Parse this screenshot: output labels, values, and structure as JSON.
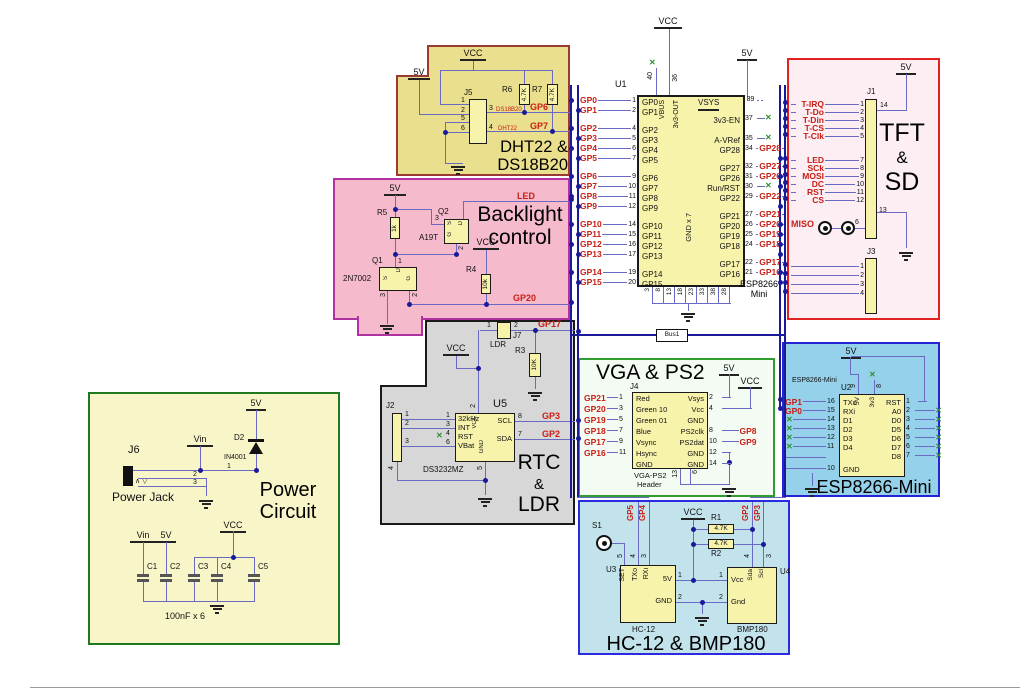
{
  "colors": {
    "bus_wire": "#1a1a99",
    "signal_wire": "#6a6ac4",
    "net_label": "#c81e14",
    "nc_mark": "#2f8f2f",
    "component_fill": "#f8f3ab",
    "dht_fill": "#eadf8d",
    "dht_border": "#9a3a33",
    "backlight_fill": "#f6bacd",
    "backlight_border": "#b231a2",
    "tft_fill": "#fdeef4",
    "tft_border": "#e02222",
    "rtc_fill": "#d7d7d7",
    "rtc_border": "#1a1a1a",
    "vga_fill": "#f3fbf3",
    "vga_border": "#2f9e2f",
    "esp_fill": "#95d1ea",
    "esp_border": "#2424d4",
    "hc12_fill": "#c2e2ec",
    "hc12_border": "#2a2ae0",
    "power_fill": "#f8f5c9",
    "power_border": "#1f7a1f"
  },
  "sheet": {
    "bus_label": "Bus1"
  },
  "u1": {
    "ref": "U1",
    "part1": "ESP8266",
    "part2": "Mini",
    "vcc": "VCC",
    "v5": "5V",
    "top_left_pin": {
      "num": "40",
      "label": "VBUS",
      "nc": "✕"
    },
    "top_right_pin": {
      "num": "36",
      "label": "3v3-OUT"
    },
    "gnd_label": "GND x 7",
    "bottom_pins": [
      "3",
      "8",
      "13",
      "18",
      "23",
      "33",
      "38",
      "28"
    ],
    "left_rows": [
      {
        "cls": "lrow",
        "net": "GP0",
        "num": "1",
        "lab": "GP0"
      },
      {
        "cls": "lrow",
        "net": "GP1",
        "num": "2",
        "lab": "GP1"
      },
      {
        "cls": "lrow gap"
      },
      {
        "cls": "lrow",
        "net": "GP2",
        "num": "4",
        "lab": "GP2"
      },
      {
        "cls": "lrow",
        "net": "GP3",
        "num": "5",
        "lab": "GP3"
      },
      {
        "cls": "lrow",
        "net": "GP4",
        "num": "6",
        "lab": "GP4"
      },
      {
        "cls": "lrow",
        "net": "GP5",
        "num": "7",
        "lab": "GP5"
      },
      {
        "cls": "lrow gap"
      },
      {
        "cls": "lrow",
        "net": "GP6",
        "num": "9",
        "lab": "GP6"
      },
      {
        "cls": "lrow",
        "net": "GP7",
        "num": "10",
        "lab": "GP7"
      },
      {
        "cls": "lrow",
        "net": "GP8",
        "num": "11",
        "lab": "GP8"
      },
      {
        "cls": "lrow",
        "net": "GP9",
        "num": "12",
        "lab": "GP9"
      },
      {
        "cls": "lrow gap"
      },
      {
        "cls": "lrow",
        "net": "GP10",
        "num": "14",
        "lab": "GP10"
      },
      {
        "cls": "lrow",
        "net": "GP11",
        "num": "15",
        "lab": "GP11"
      },
      {
        "cls": "lrow",
        "net": "GP12",
        "num": "16",
        "lab": "GP12"
      },
      {
        "cls": "lrow",
        "net": "GP13",
        "num": "17",
        "lab": "GP13"
      },
      {
        "cls": "lrow gap"
      },
      {
        "cls": "lrow",
        "net": "GP14",
        "num": "19",
        "lab": "GP14"
      },
      {
        "cls": "lrow",
        "net": "GP15",
        "num": "20",
        "lab": "GP15"
      }
    ],
    "right_rows": [
      {
        "cls": "rrow pwr",
        "num": "39",
        "lab": "VSYS"
      },
      {
        "cls": "rrow blank",
        "lab": ""
      },
      {
        "cls": "rrow gap"
      },
      {
        "cls": "rrow ncr",
        "num": "37",
        "nc": "✕",
        "lab": "3v3-EN"
      },
      {
        "cls": "rrow blank",
        "lab": ""
      },
      {
        "cls": "rrow ncr",
        "num": "35",
        "nc": "✕",
        "lab": "A-VRef"
      },
      {
        "cls": "rrow",
        "num": "34",
        "net": "GP28",
        "lab": "GP28"
      },
      {
        "cls": "rrow gap"
      },
      {
        "cls": "rrow",
        "num": "32",
        "net": "GP27",
        "lab": "GP27"
      },
      {
        "cls": "rrow",
        "num": "31",
        "net": "GP26",
        "lab": "GP26"
      },
      {
        "cls": "rrow ncr",
        "num": "30",
        "nc": "✕",
        "lab": "Run/RST"
      },
      {
        "cls": "rrow",
        "num": "29",
        "net": "GP22",
        "lab": "GP22"
      },
      {
        "cls": "rrow gap"
      },
      {
        "cls": "rrow",
        "num": "27",
        "net": "GP21",
        "lab": "GP21"
      },
      {
        "cls": "rrow",
        "num": "26",
        "net": "GP20",
        "lab": "GP20"
      },
      {
        "cls": "rrow",
        "num": "25",
        "net": "GP19",
        "lab": "GP19"
      },
      {
        "cls": "rrow",
        "num": "24",
        "net": "GP18",
        "lab": "GP18"
      },
      {
        "cls": "rrow gap"
      },
      {
        "cls": "rrow",
        "num": "22",
        "net": "GP17",
        "lab": "GP17"
      },
      {
        "cls": "rrow",
        "num": "21",
        "net": "GP16",
        "lab": "GP16"
      }
    ]
  },
  "regions": {
    "dht": {
      "title1": "DHT22 &",
      "title2": "DS18B20",
      "v5": "5V",
      "vcc": "VCC",
      "j5": {
        "ref": "J5",
        "n1": "1",
        "n2": "2",
        "n5": "5",
        "n6": "6",
        "p3": {
          "num": "3",
          "part": "DS18B20",
          "net": "GP6"
        },
        "p4": {
          "num": "4",
          "part": "DHT22",
          "net": "GP7"
        }
      },
      "r6": {
        "ref": "R6",
        "val": "4.7K"
      },
      "r7": {
        "ref": "R7",
        "val": "4.7K"
      }
    },
    "backlight": {
      "title1": "Backlight",
      "title2": "control",
      "v5": "5V",
      "vcc": "VCC",
      "led": "LED",
      "gp20": "GP20",
      "r5": {
        "ref": "R5",
        "val": "1k"
      },
      "r4": {
        "ref": "R4",
        "val": "10k"
      },
      "q2": {
        "ref": "Q2",
        "part": "A19T",
        "s": "S",
        "d": "D",
        "g": "G",
        "n3": "3",
        "n2": "2"
      },
      "q1": {
        "ref": "Q1",
        "part": "2N7002",
        "s": "S",
        "d": "D",
        "g": "G",
        "n1": "1",
        "n3": "3",
        "n2": "2"
      }
    },
    "tft": {
      "title1": "TFT",
      "title2": "&",
      "title3": "SD",
      "v5": "5V",
      "j1": {
        "ref": "J1",
        "n14": "14",
        "n13": "13",
        "miso": "MISO",
        "n6": "6",
        "rows": [
          {
            "cls": "trow",
            "net": "T-IRQ",
            "num": "1"
          },
          {
            "cls": "trow",
            "net": "T-Do",
            "num": "2"
          },
          {
            "cls": "trow",
            "net": "T-Din",
            "num": "3"
          },
          {
            "cls": "trow",
            "net": "T-CS",
            "num": "4"
          },
          {
            "cls": "trow",
            "net": "T-Clk",
            "num": "5"
          },
          {
            "cls": "trow gap"
          },
          {
            "cls": "trow",
            "net": "LED",
            "num": "7"
          },
          {
            "cls": "trow",
            "net": "SCk",
            "num": "8"
          },
          {
            "cls": "trow",
            "net": "MOSI",
            "num": "9"
          },
          {
            "cls": "trow",
            "net": "DC",
            "num": "10"
          },
          {
            "cls": "trow",
            "net": "RST",
            "num": "11"
          },
          {
            "cls": "trow",
            "net": "CS",
            "num": "12"
          }
        ]
      },
      "j3": {
        "ref": "J3",
        "pins": [
          "1",
          "2",
          "3",
          "4"
        ]
      }
    },
    "rtc": {
      "title1": "RTC",
      "title2": "&",
      "title3": "LDR",
      "vcc": "VCC",
      "j7": {
        "ref": "J7",
        "part": "LDR",
        "n1": "1",
        "n2": "2",
        "net": "GP17"
      },
      "r3": {
        "ref": "R3",
        "val": "10K"
      },
      "u5": {
        "ref": "U5",
        "part": "DS3232MZ",
        "top_lab": "VCC",
        "top_num": "2",
        "bot_lab": "GND",
        "bot_num": "5",
        "left": [
          {
            "lab": "32kHz",
            "num": "1"
          },
          {
            "lab": "INT",
            "num": "3"
          },
          {
            "lab": "RST",
            "num": "4",
            "nc": "✕"
          },
          {
            "lab": "VBat",
            "num": "6"
          }
        ],
        "right": [
          {
            "lab": "SCL",
            "num": "8",
            "net": "GP3"
          },
          {
            "lab": "SDA",
            "num": "7",
            "net": "GP2"
          }
        ]
      },
      "j2": {
        "ref": "J2",
        "n1": "1",
        "n2": "2",
        "n3": "3",
        "n4": "4"
      }
    },
    "vga": {
      "title": "VGA & PS2",
      "v5": "5V",
      "vcc": "VCC",
      "j4": {
        "ref": "J4",
        "part1": "VGA-PS2",
        "part2": "Header",
        "n13": "13",
        "n6": "6",
        "left_rows": [
          {
            "cls": "vrow",
            "lab": "Red",
            "num": "1",
            "net": "GP21"
          },
          {
            "cls": "vrow",
            "lab": "Green 10",
            "num": "3",
            "net": "GP20"
          },
          {
            "cls": "vrow",
            "lab": "Green 01",
            "num": "5",
            "net": "GP19"
          },
          {
            "cls": "vrow",
            "lab": "Blue",
            "num": "7",
            "net": "GP18"
          },
          {
            "cls": "vrow",
            "lab": "Vsync",
            "num": "9",
            "net": "GP17"
          },
          {
            "cls": "vrow",
            "lab": "Hsync",
            "num": "11",
            "net": "GP16"
          },
          {
            "cls": "vrow blank",
            "lab": "GND"
          }
        ],
        "right_rows": [
          {
            "cls": "vrow pwr1",
            "lab": "Vsys",
            "num": "2"
          },
          {
            "cls": "vrow pwr2",
            "lab": "Vcc",
            "num": "4"
          },
          {
            "cls": "vrow blank",
            "lab": "GND"
          },
          {
            "cls": "vrow",
            "lab": "PS2clk",
            "num": "8",
            "net": "GP8"
          },
          {
            "cls": "vrow",
            "lab": "PS2dat",
            "num": "10",
            "net": "GP9"
          },
          {
            "cls": "vrow gnd1",
            "lab": "GND",
            "num": "12"
          },
          {
            "cls": "vrow gnd1",
            "lab": "GND",
            "num": "14"
          }
        ]
      }
    },
    "esp": {
      "title": "ESP8266-Mini",
      "small": "ESP8266-Mini",
      "ref": "U2",
      "v5": "5V",
      "top": [
        {
          "lab": "5V",
          "num": "9"
        },
        {
          "lab": "3v3",
          "num": "8",
          "nc": "✕"
        }
      ],
      "left_rows": [
        {
          "cls": "erow",
          "lab": "TXo",
          "num": "16",
          "net": "GP1"
        },
        {
          "cls": "erow",
          "lab": "RXi",
          "num": "15",
          "net": "GP0"
        },
        {
          "cls": "erow",
          "lab": "D1",
          "num": "14",
          "nc": "✕"
        },
        {
          "cls": "erow",
          "lab": "D2",
          "num": "13",
          "nc": "✕"
        },
        {
          "cls": "erow",
          "lab": "D3",
          "num": "12",
          "nc": "✕"
        },
        {
          "cls": "erow",
          "lab": "D4",
          "num": "11",
          "nc": "✕"
        },
        {
          "cls": "erow egap"
        },
        {
          "cls": "erow",
          "lab": "GND",
          "num": "10"
        }
      ],
      "right_rows": [
        {
          "cls": "erow pwrR",
          "lab": "RST",
          "num": "1"
        },
        {
          "cls": "erow ncr2",
          "lab": "A0",
          "num": "2",
          "nc": "✕"
        },
        {
          "cls": "erow ncr2",
          "lab": "D0",
          "num": "3",
          "nc": "✕"
        },
        {
          "cls": "erow ncr2",
          "lab": "D5",
          "num": "4",
          "nc": "✕"
        },
        {
          "cls": "erow ncr2",
          "lab": "D6",
          "num": "5",
          "nc": "✕"
        },
        {
          "cls": "erow ncr2",
          "lab": "D7",
          "num": "6",
          "nc": "✕"
        },
        {
          "cls": "erow ncr2",
          "lab": "D8",
          "num": "7",
          "nc": "✕"
        }
      ]
    },
    "hc12": {
      "title": "HC-12 & BMP180",
      "vcc": "VCC",
      "s1": "S1",
      "gp5": "GP5",
      "gp4": "GP4",
      "gp2": "GP2",
      "gp3": "GP3",
      "r1": {
        "ref": "R1",
        "val": "4.7K"
      },
      "r2": {
        "ref": "R2",
        "val": "4.7K"
      },
      "u3": {
        "ref": "U3",
        "part": "HC-12",
        "set": "SET",
        "txo": "TXo",
        "rxi": "RXi",
        "n5": "5",
        "n4": "4",
        "n3": "3",
        "p5v": "5V",
        "n1": "1",
        "gnd": "GND",
        "n2": "2"
      },
      "u4": {
        "ref": "U4",
        "part": "BMP180",
        "vcc": "Vcc",
        "n1": "1",
        "gnd": "Gnd",
        "n2": "2",
        "sda": "Sda",
        "n4": "4",
        "scl": "Scl",
        "n3": "3"
      }
    },
    "power": {
      "title1": "Power",
      "title2": "Circuit",
      "vin": "Vin",
      "v5": "5V",
      "vcc": "VCC",
      "j6": {
        "ref": "J6",
        "part": "Power Jack",
        "n1": "1",
        "n2": "2",
        "n3": "3",
        "marks": "∧ ▽"
      },
      "d2": {
        "ref": "D2",
        "part": "IN4001"
      },
      "rail_vin": "Vin",
      "rail_5v": "5V",
      "rail_vcc": "VCC",
      "caps": [
        "C1",
        "C2",
        "C3",
        "C4",
        "C5"
      ],
      "cap_note": "100nF x 6"
    }
  }
}
